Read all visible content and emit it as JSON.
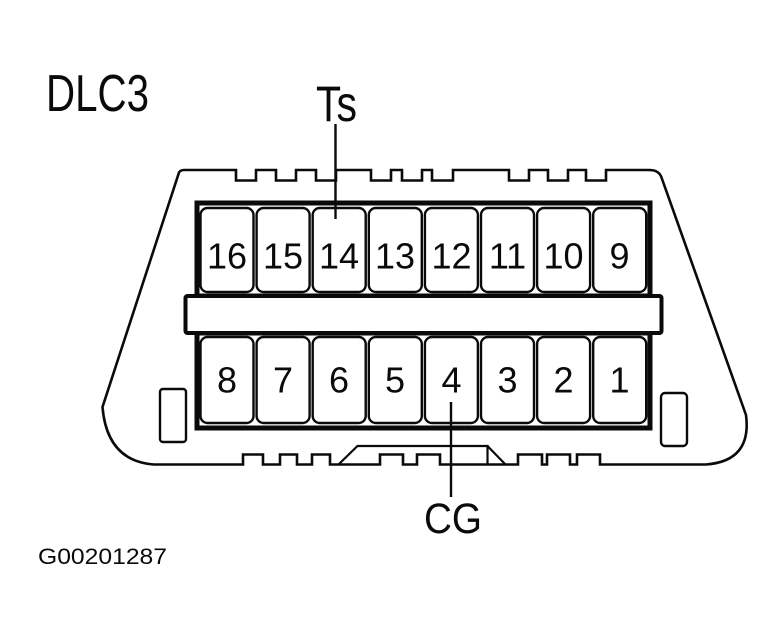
{
  "figure": {
    "title": "DLC3",
    "figure_number": "G00201287",
    "connector": {
      "rows": {
        "top": [
          "16",
          "15",
          "14",
          "13",
          "12",
          "11",
          "10",
          "9"
        ],
        "bottom": [
          "8",
          "7",
          "6",
          "5",
          "4",
          "3",
          "2",
          "1"
        ]
      },
      "pin_labels": {
        "ts": {
          "text": "Ts",
          "pin": "14"
        },
        "cg": {
          "text": "CG",
          "pin": "4"
        }
      }
    },
    "colors": {
      "line": "#0a0a0a",
      "background": "#ffffff"
    }
  }
}
